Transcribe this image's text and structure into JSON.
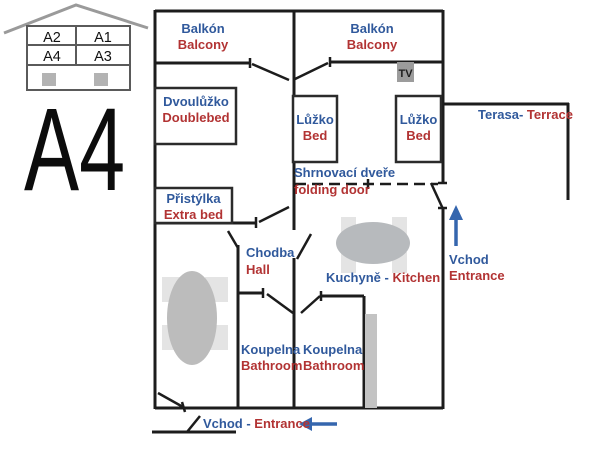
{
  "unit": {
    "label": "A4"
  },
  "building_diagram": {
    "units": [
      "A2",
      "A1",
      "A4",
      "A3"
    ]
  },
  "colors": {
    "czech_label_blue": "#30599c",
    "english_label_red": "#b23333",
    "wall_black": "#1c1c1c",
    "arrow_blue": "#3566ae",
    "furniture_gray": "#b7babd",
    "tv_gray": "#9c9c9c"
  },
  "labels": {
    "balcony_left": {
      "cz": "Balkón",
      "en": "Balcony"
    },
    "balcony_right": {
      "cz": "Balkón",
      "en": "Balcony"
    },
    "doublebed": {
      "cz": "Dvoulůžko",
      "en": "Doublebed"
    },
    "bed_left": {
      "cz": "Lůžko",
      "en": "Bed"
    },
    "bed_right": {
      "cz": "Lůžko",
      "en": "Bed"
    },
    "terrace": {
      "cz": "Terasa-",
      "en": "Terrace"
    },
    "folding_door": {
      "cz": "Shrnovací dveře",
      "en": "folding door"
    },
    "extra_bed": {
      "cz": "Přistýlka",
      "en": "Extra bed"
    },
    "hall": {
      "cz": "Chodba",
      "en": "Hall"
    },
    "kitchen": {
      "cz": "Kuchyně -",
      "en": "Kitchen"
    },
    "entrance_right": {
      "cz": "Vchod",
      "en": "Entrance"
    },
    "bathroom_left": {
      "cz": "Koupelna",
      "en": "Bathroom"
    },
    "bathroom_right": {
      "cz": "Koupelna",
      "en": "Bathroom"
    },
    "entrance_bottom": {
      "cz": "Vchod -",
      "en": "Entrance"
    },
    "tv": "TV"
  }
}
